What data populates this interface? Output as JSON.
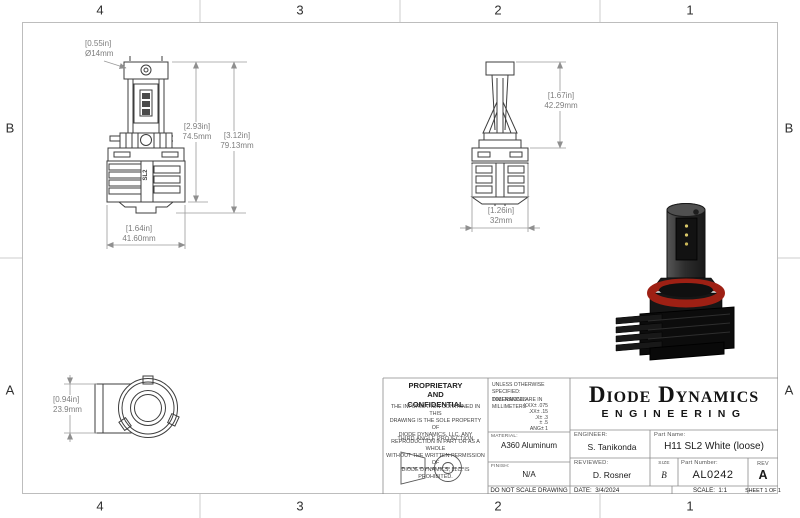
{
  "zones": {
    "top": [
      "4",
      "3",
      "2",
      "1"
    ],
    "bottom": [
      "4",
      "3",
      "2",
      "1"
    ],
    "left": [
      "B",
      "A"
    ],
    "right": [
      "B",
      "A"
    ]
  },
  "views": {
    "front": {
      "body_logo": "SL2",
      "dims": {
        "diameter": [
          "[0.55in]",
          "Ø14mm"
        ],
        "body_height": [
          "[2.93in]",
          "74.5mm"
        ],
        "total_height": [
          "[3.12in]",
          "79.13mm"
        ],
        "width": [
          "[1.64in]",
          "41.60mm"
        ]
      }
    },
    "side": {
      "dims": {
        "bulb_height": [
          "[1.67in]",
          "42.29mm"
        ],
        "base_width": [
          "[1.26in]",
          "32mm"
        ]
      }
    },
    "rear": {
      "dims": {
        "barrel_diameter": [
          "[0.94in]",
          "23.9mm"
        ]
      }
    }
  },
  "title_block": {
    "proprietary_title": "PROPRIETARY\nAND\nCONFIDENTIAL",
    "proprietary_body": "THE INFORMATION CONTAINED IN THIS\nDRAWING IS THE SOLE PROPERTY OF\nDIODE DYNAMICS, LLC.  ANY\nREPRODUCTION IN PART OR AS A WHOLE\nWITHOUT THE WRITTEN PERMISSION OF\nDIODE DYNAMICS, LLC. IS PROHIBITED.",
    "third_angle": "THIRD ANGLE PROJECTION",
    "spec_note": "UNLESS OTHERWISE SPECIFIED:\nDIMENSIONS ARE IN MILLIMETERS",
    "tolerances_label": "TOLERANCES:",
    "tolerances": [
      ".XXX± .075",
      ".XX± .15",
      ".X± .3",
      "± .5",
      "ANG± 1"
    ],
    "material_label": "MATERIAL:",
    "material": "A360 Aluminum",
    "finish_label": "FINISH:",
    "finish": "N/A",
    "do_not_scale": "DO NOT SCALE DRAWING",
    "logo_line1": "Diode Dynamics",
    "logo_line2": "ENGINEERING",
    "engineer_label": "ENGINEER:",
    "engineer": "S. Tanikonda",
    "part_name_label": "Part Name:",
    "part_name": "H11 SL2 White (loose)",
    "reviewed_label": "REVIEWED:",
    "reviewed": "D. Rosner",
    "size_label": "SIZE",
    "size": "B",
    "part_number_label": "Part Number:",
    "part_number": "AL0242",
    "rev_label": "REV",
    "rev": "A",
    "date_label": "DATE:",
    "date": "3/4/2024",
    "scale_label": "SCALE:",
    "scale_value": "1:1",
    "sheet": "SHEET 1 OF 1"
  },
  "colors": {
    "line": "#3d3d3d",
    "dimension": "#8f8f8f",
    "border": "#bdbdbd",
    "gasket_red": "#9e2014",
    "product_black": "#141414"
  }
}
